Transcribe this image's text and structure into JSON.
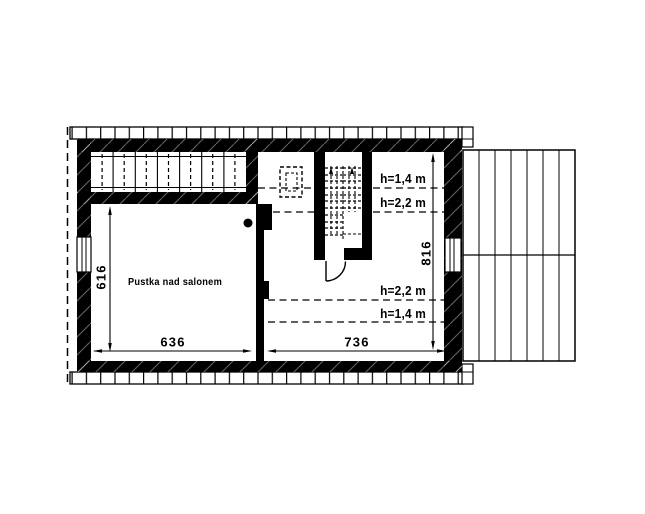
{
  "floor_plan": {
    "room_label": "Pustka nad salonem",
    "height_annotations": {
      "top_low": "h=1,4 m",
      "top_high": "h=2,2 m",
      "bottom_high": "h=2,2 m",
      "bottom_low": "h=1,4 m"
    },
    "dimensions": {
      "bottom_left_width": "636",
      "bottom_right_width": "736",
      "left_depth": "616",
      "right_depth": "816"
    },
    "colors": {
      "ink": "#000000",
      "paper": "#ffffff"
    }
  }
}
